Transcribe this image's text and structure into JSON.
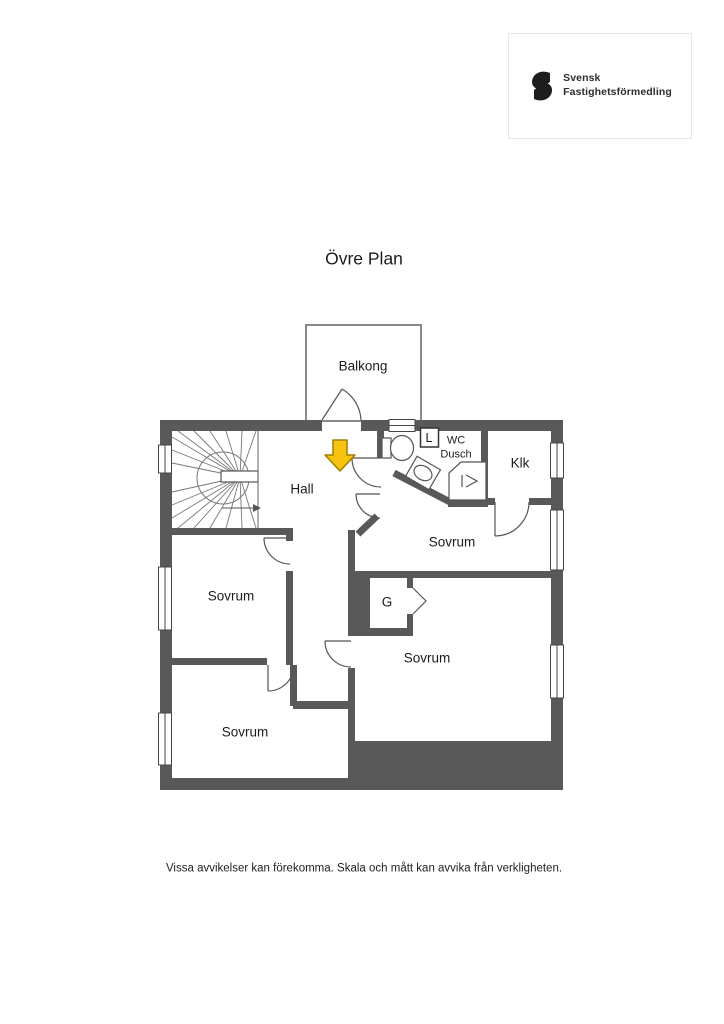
{
  "logo": {
    "brand_line1": "Svensk",
    "brand_line2": "Fastighetsförmedling",
    "icon": "sf-monogram"
  },
  "plan": {
    "title": "Övre Plan",
    "rooms": {
      "balcony": "Balkong",
      "hall": "Hall",
      "wc_line1": "WC",
      "wc_line2": "Dusch",
      "laundry_box": "L",
      "closet": "Klk",
      "bedroom_top": "Sovrum",
      "bedroom_left": "Sovrum",
      "wardrobe": "G",
      "bedroom_bottom_right": "Sovrum",
      "bedroom_bottom_left": "Sovrum"
    },
    "icons": {
      "entry_arrow": "down-arrow",
      "stair_direction": "right-arrow",
      "shower_symbol": "shower-chevron"
    },
    "colors": {
      "wall": "#595959",
      "thin_line": "#555555",
      "entry_arrow_fill": "#f6c40e",
      "entry_arrow_stroke": "#a08000",
      "text": "#1c1c1c"
    }
  },
  "footer": {
    "disclaimer": "Vissa avvikelser kan förekomma. Skala och mått kan avvika från verkligheten."
  }
}
